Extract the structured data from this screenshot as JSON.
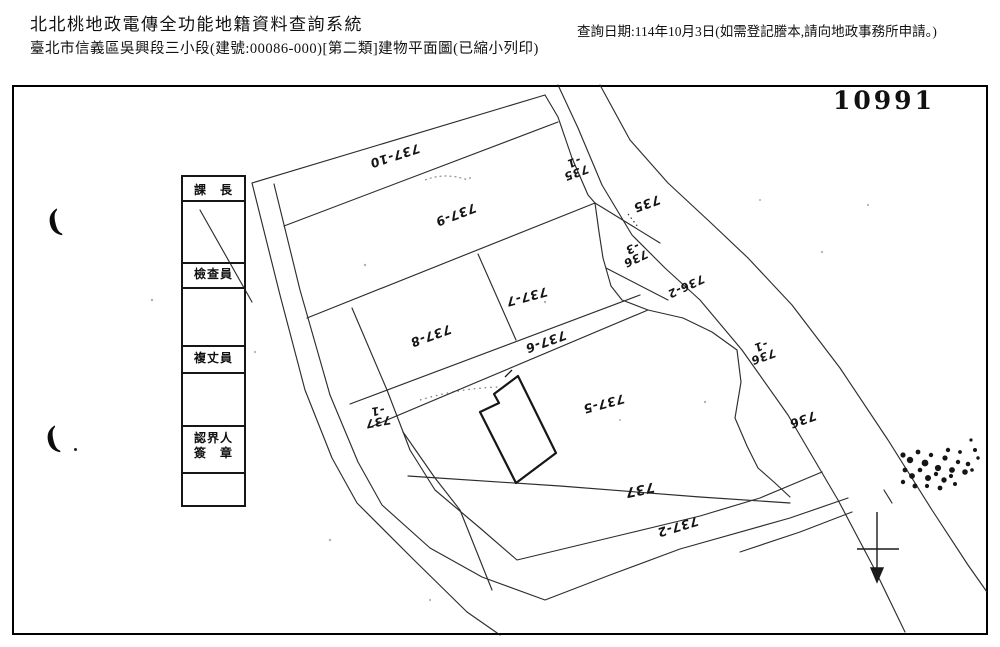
{
  "header": {
    "system_title": "北北桃地政電傳全功能地籍資料查詢系統",
    "document_title": "臺北市信義區吳興段三小段(建號:00086-000)[第二類]建物平面圖(已縮小列印)",
    "query_date_note": "查詢日期:114年10月3日(如需登記謄本,請向地政事務所申請。)"
  },
  "map": {
    "sheet_number": "10991",
    "signature_table": {
      "rows": [
        {
          "l1": "課　長",
          "l2": ""
        },
        {
          "l1": "檢查員",
          "l2": ""
        },
        {
          "l1": "複丈員",
          "l2": ""
        },
        {
          "l1": "認界人",
          "l2": "簽　章"
        }
      ]
    },
    "parcels": [
      {
        "id": "737-10",
        "l1": "737-10",
        "l2": ""
      },
      {
        "id": "737-9",
        "l1": "737-9",
        "l2": ""
      },
      {
        "id": "735-1",
        "l1": "735",
        "l2": "-1"
      },
      {
        "id": "735",
        "l1": "735",
        "l2": ""
      },
      {
        "id": "736-3",
        "l1": "736",
        "l2": "-3"
      },
      {
        "id": "736-2",
        "l1": "736-2",
        "l2": ""
      },
      {
        "id": "737-7",
        "l1": "737-7",
        "l2": ""
      },
      {
        "id": "737-8",
        "l1": "737-8",
        "l2": ""
      },
      {
        "id": "737-6",
        "l1": "737-6",
        "l2": ""
      },
      {
        "id": "736-1",
        "l1": "736",
        "l2": "-1"
      },
      {
        "id": "737-5",
        "l1": "737-5",
        "l2": ""
      },
      {
        "id": "736",
        "l1": "736",
        "l2": ""
      },
      {
        "id": "737-1",
        "l1": "737",
        "l2": "-1"
      },
      {
        "id": "737",
        "l1": "737",
        "l2": ""
      },
      {
        "id": "737-2",
        "l1": "737-2",
        "l2": ""
      }
    ],
    "margin_marks": {
      "upper": "(",
      "lower": "("
    },
    "ink_color": "#1c1c1c"
  }
}
